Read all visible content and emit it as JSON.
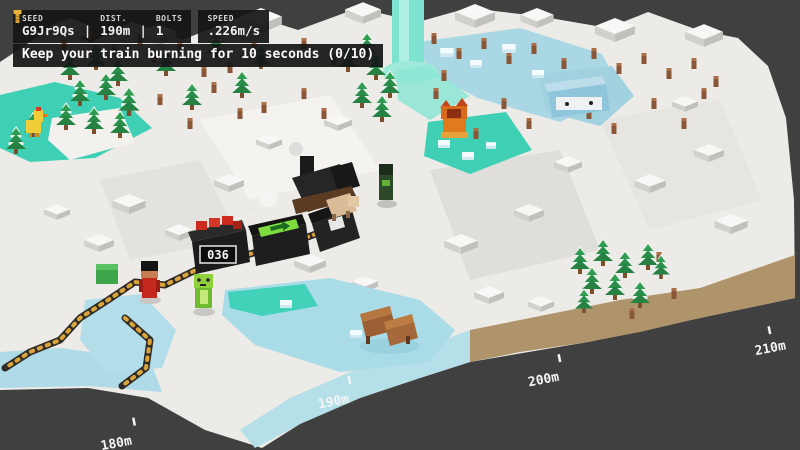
{
  "hud": {
    "panel1": {
      "columns": [
        {
          "label": "SEED",
          "value": "G9Jr9Qs"
        },
        {
          "label": "DIST.",
          "value": "190m"
        },
        {
          "label": "BOLTS",
          "value": "1"
        }
      ],
      "separator": "|"
    },
    "panel2": {
      "label": "SPEED",
      "value": ".226m/s"
    }
  },
  "objective": {
    "text": "Keep your train burning for 10 seconds (0/10)"
  },
  "train": {
    "counter": "036"
  },
  "markers": {
    "m180": "180m",
    "m190": "190m",
    "m200": "200m",
    "m210": "210m"
  },
  "icons": {
    "bolt": "gold-bolt"
  },
  "colors": {
    "background": "#404040",
    "hud_panel": "#161616",
    "hud_text": "#f2f2f2",
    "gold": "#e2ab3a",
    "snow": "#ecebe7",
    "ice": "#abd9e5",
    "water": "#3fcfb4",
    "tree_green": "#2f9e52",
    "dirt_edge": "#b0956c",
    "train_black": "#1c1c1c",
    "train_red": "#cc2a1f",
    "player_red": "#c5281e",
    "player_green": "#7ec83a",
    "fox_orange": "#e07a1f",
    "chicken_yellow": "#f2cd3a"
  }
}
